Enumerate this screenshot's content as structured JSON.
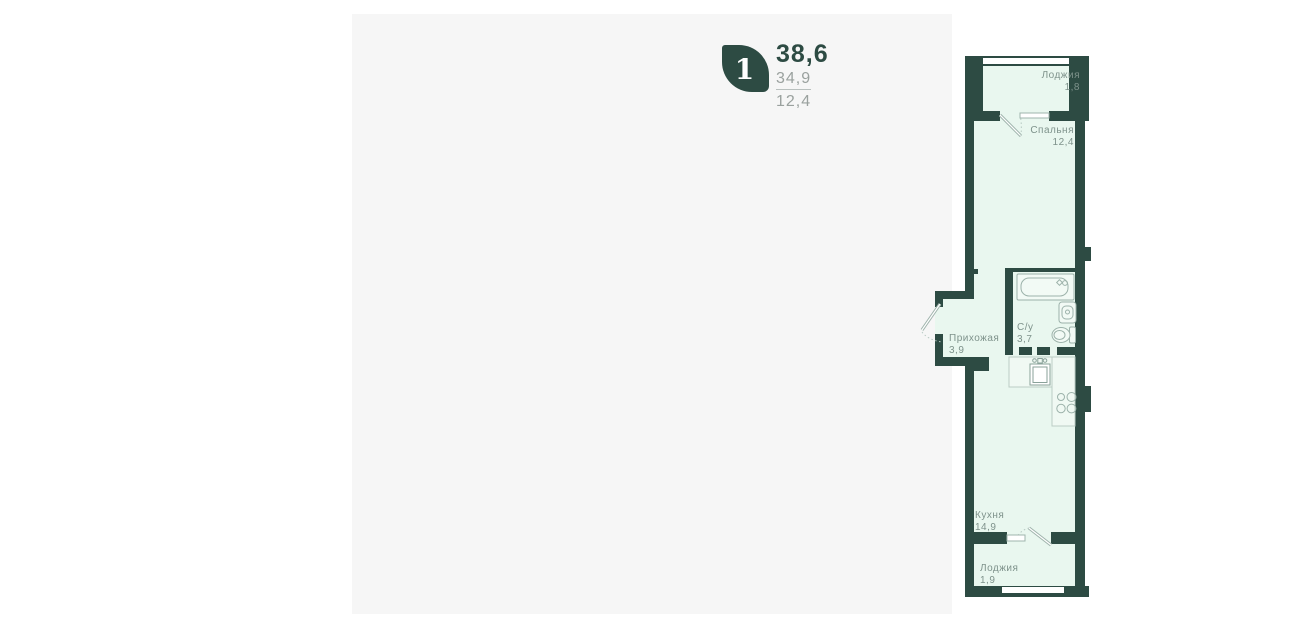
{
  "card": {
    "unit_number": "1",
    "total_area": "38,6",
    "living_area": "34,9",
    "kitchen_area": "12,4"
  },
  "plan": {
    "rooms": [
      {
        "id": "loggia-top",
        "name": "Лоджия",
        "area": "1,8"
      },
      {
        "id": "bedroom",
        "name": "Спальня",
        "area": "12,4"
      },
      {
        "id": "hallway",
        "name": "Прихожая",
        "area": "3,9"
      },
      {
        "id": "bathroom",
        "name": "С/у",
        "area": "3,7"
      },
      {
        "id": "kitchen",
        "name": "Кухня",
        "area": "14,9"
      },
      {
        "id": "loggia-bottom",
        "name": "Лоджия",
        "area": "1,9"
      }
    ]
  },
  "colors": {
    "brand": "#2d4b43",
    "wall": "#2d4b43",
    "floor": "#e9f7ef",
    "panel": "#f6f6f6",
    "muted": "#9aa19e",
    "label": "#7e928b"
  }
}
